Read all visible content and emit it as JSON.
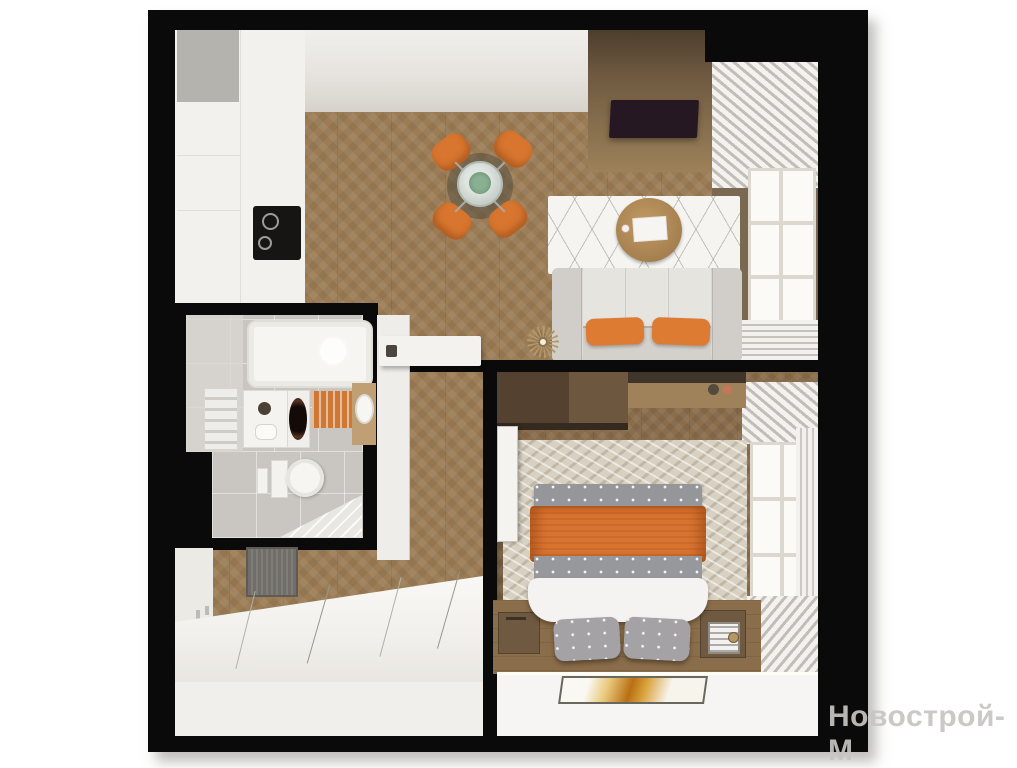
{
  "watermark": {
    "text": "Новострой-М",
    "color": "#c7c5c2"
  },
  "scene": {
    "type": "3d-apartment-floor-plan-render",
    "background_color": "#ffffff",
    "wall_color": "#0a0a0a",
    "floor_wood_color": "#9b7c55",
    "accent_orange": "#d97330",
    "rooms": [
      "kitchen",
      "living-dining-room",
      "bathroom",
      "hallway-entry",
      "bedroom"
    ],
    "furniture": {
      "kitchen": [
        "white-cabinets",
        "gray-corner-cabinet",
        "black-cooktop"
      ],
      "living-dining-room": [
        "round-glass-dining-table",
        "four-orange-chairs",
        "white-sofa",
        "two-orange-cushions",
        "round-coffee-table",
        "patterned-white-rug",
        "tv-wood-panel",
        "window-with-curtains",
        "gold-ceiling-light"
      ],
      "bathroom": [
        "bathtub",
        "towel-radiator",
        "cabinet",
        "washing-machine",
        "orange-bath-mat",
        "sink-on-wood-counter",
        "toilet",
        "corner-shower-tray"
      ],
      "hallway-entry": [
        "gray-doormat",
        "white-wardrobe",
        "console-shelf",
        "open-door"
      ],
      "bedroom": [
        "dark-wardrobe",
        "desk",
        "double-bed-orange-blanket",
        "gray-dotted-pillows",
        "two-nightstands",
        "beige-rug",
        "window-with-curtains",
        "wall-art"
      ]
    }
  }
}
